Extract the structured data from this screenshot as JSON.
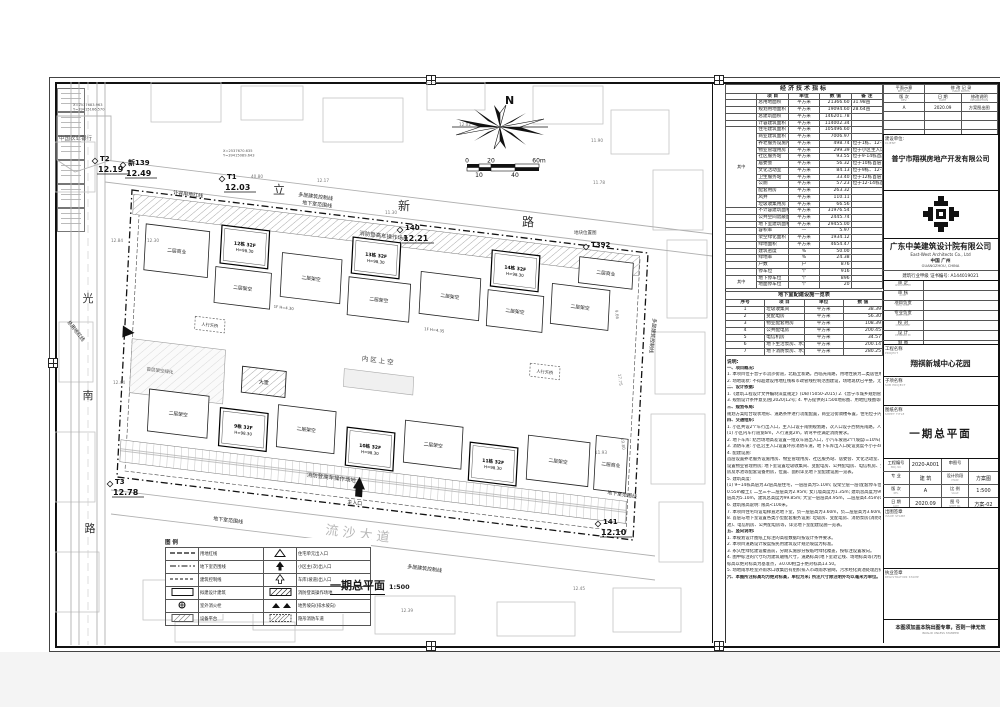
{
  "econ_table": {
    "title": "经济技术指标",
    "headers": [
      "项  目",
      "单位",
      "数  值",
      "备  注"
    ],
    "groups": [
      {
        "start": 4,
        "span": 12,
        "label": "其中"
      },
      {
        "start": 26,
        "span": 2,
        "label": "其中"
      }
    ],
    "rows": [
      [
        "总用地面积",
        "平方米",
        "21366.60",
        "31.98亩"
      ],
      [
        "规划用地面积",
        "平方米",
        "19094.60",
        "28.64亩"
      ],
      [
        "总建筑面积",
        "平方米",
        "146201.78",
        ""
      ],
      [
        "计容建筑面积",
        "平方米",
        "114002.34",
        ""
      ],
      [
        "住宅建筑面积",
        "平方米",
        "105496.60",
        ""
      ],
      [
        "商业建筑面积",
        "平方米",
        "7006.97",
        ""
      ],
      [
        "养老服务设施用房",
        "平方米",
        "498.74",
        "位于1栋、12-14栋首层"
      ],
      [
        "物业管理用房",
        "平方米",
        "299.39",
        "位于小区主入口首二层"
      ],
      [
        "社区服务站",
        "平方米",
        "93.55",
        "位于9-14栋首层"
      ],
      [
        "居委会",
        "平方米",
        "56.32",
        "位于10栋首层"
      ],
      [
        "文化活动室",
        "平方米",
        "84.13",
        "位于9栋、12-14栋首层"
      ],
      [
        "卫生服务站",
        "平方米",
        "33.40",
        "位于12栋首层"
      ],
      [
        "公厕",
        "平方米",
        "57.23",
        "位于12-14栋首层"
      ],
      [
        "配套用房",
        "平方米",
        "263.32",
        ""
      ],
      [
        "风井",
        "平方米",
        "110.11",
        ""
      ],
      [
        "垃圾收集用房",
        "平方米",
        "66.56",
        ""
      ],
      [
        "不计容建筑面积",
        "平方米",
        "31976.54",
        ""
      ],
      [
        "公共空间遮蔽面积",
        "平方米",
        "2445.74",
        ""
      ],
      [
        "地下室建筑面积",
        "平方米",
        "29455.00",
        ""
      ],
      [
        "容积率",
        "—",
        "5.97",
        ""
      ],
      [
        "架空绿化面积",
        "平方米",
        "1934.12",
        ""
      ],
      [
        "绿地面积",
        "平方米",
        "4654.47",
        ""
      ],
      [
        "建筑密度",
        "%",
        "50.00",
        ""
      ],
      [
        "绿地率",
        "%",
        "24.38",
        ""
      ],
      [
        "户数",
        "户",
        "876",
        ""
      ],
      [
        "停车位",
        "个",
        "916",
        ""
      ],
      [
        "地下停车位",
        "个",
        "896",
        ""
      ],
      [
        "地面停车位",
        "个",
        "20",
        ""
      ]
    ]
  },
  "facility_table": {
    "title": "地下室配建设施一览表",
    "headers": [
      "序号",
      "项  目",
      "单位",
      "数  值"
    ],
    "rows": [
      [
        "1",
        "垃圾收集间",
        "平方米",
        "38.39"
      ],
      [
        "2",
        "变配电房",
        "平方米",
        "56.30"
      ],
      [
        "3",
        "物业配套用房",
        "平方米",
        "108.39"
      ],
      [
        "4",
        "公共配电房",
        "平方米",
        "200.45"
      ],
      [
        "5",
        "电信机房",
        "平方米",
        "34.57"
      ],
      [
        "6",
        "地下生活泵房、水池",
        "平方米",
        "200.14"
      ],
      [
        "7",
        "地下消防泵房、水池",
        "平方米",
        "280.25"
      ]
    ]
  },
  "notes": {
    "title": "说明:",
    "lines": [
      "一、项目概况:",
      "1. 本项目位于普宁市流沙街道，北临立新路，西临光南路，用地性质为二类居住用地。",
      "2. 场地现状: 不得超建设用地红线和市政管线控制范围建设，场地现状已平整，无保留建筑物。",
      "二、设计依据:",
      "1.《建筑工程设计文件编制深度规定》(DB/T5050-2015)   2.《普宁市城乡规划管理技术规定》",
      "3. 规划设计条件意见函[2020]12号;  4. 甲方提供的1:500地形图、用地红线图等相关资料。",
      "三、规划布局:",
      "规划方案结合现状地形、道路条件进行功能配置，商业沿街骑楼布置，住宅位于内区，形成完整小区。",
      "四、交通组织:",
      "1. 小区共设2个车行出入口，主入口设于南侧规划路，次入口设于西侧光南路，人车分流。",
      "(1) 小区内车行道宽6m，人行道宽2m，转弯半径满足消防要求。",
      "2. 地下车库: 结合场地高差设置一组双车道出入口，小汽车坡道2个(坡度i=10%)，直通地下停车库。",
      "3. 消防车道: 小区沿主入口设置环形消防车道，地下车库出入口处设宽度不小于4m消防通道。",
      "4. 配建设施:",
      "首层设置养老服务设施用房、物业管理用房、社区服务站、居委会、文化活动室、卫生服务站等; 住宅二层",
      "设置物业管理用房; 地下室设置垃圾收集间、变配电房、公共配电房、电信机房、生活泵房及水池、消防泵",
      "房及水池等配套设备用房，位置、面积详见地下室配建设施一览表。",
      "5. 建筑高度:",
      "(1) 9~14栋高层为32层高层住宅，一层层高为5.10m; 设架空层一层(配套停车位)，层高为4.45m(3.9m+",
      "0.55m覆土); 二至三十二层层高为2.95m; 女儿墙高度为1.35m; 建筑总高度为99.85m; 14栋含一层为商业，",
      "层高为5.10m，建筑总高度为99.85m; 大堂一层层高4.95m，二层层高4.45m(0.4m覆土层)，总高度99.75m。",
      "6. 建筑限高说明: 限高<100米。",
      "7. 本项目住宅均设电梯直达地下室，负一层层高为3.60m，负二层层高为3.60m。",
      "8. 首层与地下室设置各类小型配套服务设施: 垃圾房、变配电房、消防泵房(消防水池)、生活泵房(生活水",
      "池)、电信机房、公共配电房等，详见地下室配建设施一览表。",
      "五、竖向说明:",
      "1. 本规划设计图纸上标注的高程数据均按设计条件要求。",
      "2. 本项目道路设计坡度按民用建筑设计规范坡度为标准。",
      "3. 永久性绿化建设覆盖前，分期实施部分按临时绿化覆盖，按标注设置坡向。",
      "4. 图中标注的尺寸均为建筑轴线尺寸，道路标高(地下室退让线、场地标高等)为控制点标高，建筑物设计",
      "标高以绝对标高为基准点，±0.00相当于绝对标高13.50。",
      "5. 场地雨水经室外雨水口收集后有组织排入市政雨水管网，污水经化粪池处理后排入市政污水管。",
      "六、本图所注标高均为绝对标高，单位为米; 所注尺寸除注明外均以毫米为单位。"
    ]
  },
  "revision": {
    "key_plan": "平面示意",
    "key_plan_en": "KEY PLAN",
    "title": "修 改 记 录",
    "title_en": "ISSUE NOTES",
    "headers": [
      {
        "cn": "版 次",
        "en": "REV."
      },
      {
        "cn": "日 期",
        "en": "DATE"
      },
      {
        "cn": "修改说明",
        "en": "DESCRIPTION"
      }
    ],
    "rows": [
      [
        "A",
        "2020.09",
        "方案图出图"
      ],
      [
        "",
        "",
        ""
      ],
      [
        "",
        "",
        ""
      ],
      [
        "",
        "",
        ""
      ]
    ]
  },
  "client": {
    "label": "建设单位:",
    "label_en": "CLIENT",
    "name": "普宁市翔祺房地产开发有限公司"
  },
  "firm": {
    "name": "广东中美建筑设计院有限公司",
    "name_en": "East-West Architects Co., Ltd",
    "city": "中国 广州",
    "city_en": "GUANGZHOU, CHINA",
    "cert": "建筑行业甲级  证书编号: A144019021"
  },
  "signatures": [
    {
      "cn": "审 定",
      "en": "APPROVED BY"
    },
    {
      "cn": "审 核",
      "en": "AUDIT"
    },
    {
      "cn": "项目负责",
      "en": "PROJ. CHIEF"
    },
    {
      "cn": "专业负责",
      "en": "PROF. CHIEF"
    },
    {
      "cn": "校 对",
      "en": "CHECKED BY"
    },
    {
      "cn": "设 计",
      "en": "DESIGNED BY"
    },
    {
      "cn": "制 图",
      "en": "DRAWN BY"
    }
  ],
  "project": {
    "label": "工程名称",
    "label_en": "PROJECT",
    "name": "翔祺新城中心花园"
  },
  "subproject": {
    "label": "子项名称",
    "label_en": "SUB PROJECT",
    "name": ""
  },
  "sheet_title": {
    "label": "图纸名称",
    "label_en": "SHEET TITLE",
    "name": "一期总平面"
  },
  "info_grid": [
    {
      "l1": "工程编号",
      "e1": "PROJ. NO.",
      "v1": "2020-A001",
      "l2": "审图号",
      "e2": "",
      "v2": ""
    },
    {
      "l1": "专 业",
      "e1": "",
      "v1": "建 筑",
      "l2": "设计阶段",
      "e2": "PHASE",
      "v2": "方案图"
    },
    {
      "l1": "版 次",
      "e1": "REV.",
      "v1": "A",
      "l2": "比 例",
      "e2": "SCALE",
      "v2": "1:500"
    },
    {
      "l1": "日 期",
      "e1": "DATE",
      "v1": "2020.09",
      "l2": "图 号",
      "e2": "SHEET NO.",
      "v2": "方案-02"
    }
  ],
  "stamps": {
    "issue_cn": "出图签章",
    "issue_en": "ISSUE STAMP",
    "reg_cn": "执业签章",
    "reg_en": "REGISTRATION STAMP",
    "notice": "本图须加盖本院出图专章，否则一律无效",
    "notice_en": "INVALID UNLESS STAMPED"
  },
  "plan": {
    "title": "一期总平面",
    "scale": "1:500",
    "north_label": "N",
    "scalebar_labels_top": [
      "0",
      "20",
      "60m"
    ],
    "scalebar_labels_bottom": [
      "10",
      "40"
    ],
    "bank_label": "中国农业银行",
    "road_labels": [
      {
        "t": "光",
        "x": 33,
        "y": 220,
        "s": 11
      },
      {
        "t": "南",
        "x": 33,
        "y": 317,
        "s": 11
      },
      {
        "t": "路",
        "x": 35,
        "y": 450,
        "s": 11
      },
      {
        "t": "立",
        "x": 224,
        "y": 112,
        "s": 12
      },
      {
        "t": "新",
        "x": 349,
        "y": 128,
        "s": 12
      },
      {
        "t": "路",
        "x": 473,
        "y": 144,
        "s": 12
      }
    ],
    "street_name": {
      "t": "流 沙 大 道",
      "x": 270,
      "y": 452,
      "r": 7
    },
    "benchmarks": [
      {
        "name": "T2",
        "elev": "12.19",
        "x": 40,
        "y": 78
      },
      {
        "name": "新139",
        "elev": "12.49",
        "x": 68,
        "y": 82
      },
      {
        "name": "T1",
        "elev": "12.03",
        "x": 167,
        "y": 96
      },
      {
        "name": "140",
        "elev": "12.21",
        "x": 345,
        "y": 147
      },
      {
        "name": "T392",
        "elev": "",
        "x": 531,
        "y": 164
      },
      {
        "name": "141",
        "elev": "12.10",
        "x": 543,
        "y": 441
      },
      {
        "name": "T3",
        "elev": "12.78",
        "x": 55,
        "y": 401
      }
    ],
    "map_ref": {
      "t": "地块位置图",
      "x": 519,
      "y": 152
    },
    "coords": [
      {
        "t1": "X=2537683.963",
        "t2": "Y=39415166.570",
        "x": 18,
        "y": 24
      },
      {
        "t1": "X=2537670.635",
        "t2": "Y=39415089.643",
        "x": 168,
        "y": 70
      }
    ],
    "line_labels": [
      {
        "t": "计容用地红线",
        "x": 118,
        "y": 112,
        "r": 7
      },
      {
        "t": "多层建筑控制线",
        "x": 243,
        "y": 114,
        "r": 7
      },
      {
        "t": "地下室范围线",
        "x": 247,
        "y": 122,
        "r": 7
      },
      {
        "t": "地下室范围线",
        "x": 158,
        "y": 438,
        "r": 7
      },
      {
        "t": "计容用地红线",
        "x": 120,
        "y": 464,
        "r": 7
      },
      {
        "t": "多层建筑控制线",
        "x": 352,
        "y": 486,
        "r": 7
      },
      {
        "t": "多层建筑控制线",
        "x": 598,
        "y": 236,
        "r": 96
      },
      {
        "t": "地下室范围线",
        "x": 552,
        "y": 412,
        "r": 8
      },
      {
        "t": "总用地红线",
        "x": 12,
        "y": 240,
        "r": 52
      }
    ],
    "spot_elevations": [
      {
        "v": "12.02",
        "x": 404,
        "y": 44
      },
      {
        "v": "11.90",
        "x": 536,
        "y": 60
      },
      {
        "v": "11.78",
        "x": 538,
        "y": 102
      },
      {
        "v": "11.93",
        "x": 540,
        "y": 372
      },
      {
        "v": "12.45",
        "x": 518,
        "y": 508
      },
      {
        "v": "12.84",
        "x": 56,
        "y": 160
      },
      {
        "v": "12.30",
        "x": 92,
        "y": 160
      },
      {
        "v": "12.83",
        "x": 118,
        "y": 480
      },
      {
        "v": "12.72",
        "x": 232,
        "y": 494
      },
      {
        "v": "12.73",
        "x": 112,
        "y": 524
      },
      {
        "v": "12.39",
        "x": 346,
        "y": 530
      },
      {
        "v": "12.44",
        "x": 58,
        "y": 302
      },
      {
        "v": "12.17",
        "x": 262,
        "y": 100
      },
      {
        "v": "40.80",
        "x": 196,
        "y": 96
      },
      {
        "v": "11.30",
        "x": 330,
        "y": 132
      },
      {
        "v": "9.66",
        "x": 560,
        "y": 228,
        "r": 83
      },
      {
        "v": "17.75",
        "x": 563,
        "y": 292,
        "r": 83
      },
      {
        "v": "19.80",
        "x": 566,
        "y": 356,
        "r": 83
      }
    ],
    "site": {
      "boundary": [
        [
          77,
          108
        ],
        [
          593,
          171
        ],
        [
          578,
          458
        ],
        [
          62,
          395
        ]
      ],
      "fire_lane_label": "消防登高车操作场地",
      "courtyard_label": "内区上空",
      "bridge_label": "人行天桥",
      "lobby_label": "大堂",
      "green_label": "首层架空绿化",
      "main_entrance_label": "主入口",
      "small_texts": [
        {
          "t": "1F H=4.30",
          "x": 148,
          "y": 100
        },
        {
          "t": "1F H=4.35",
          "x": 300,
          "y": 104
        }
      ],
      "buildings": [
        {
          "x": 16,
          "y": 32,
          "w": 64,
          "h": 46,
          "t": "p",
          "label": "二层商业"
        },
        {
          "x": 92,
          "y": 24,
          "w": 48,
          "h": 38,
          "t": "tw",
          "label": "12栋 32F",
          "sub": "H=98.30"
        },
        {
          "x": 88,
          "y": 66,
          "w": 56,
          "h": 36,
          "t": "p",
          "label": "二层架空"
        },
        {
          "x": 154,
          "y": 44,
          "w": 60,
          "h": 44,
          "t": "p",
          "label": "二层架空"
        },
        {
          "x": 224,
          "y": 20,
          "w": 48,
          "h": 36,
          "t": "tw",
          "label": "13栋 32F",
          "sub": "H=98.30"
        },
        {
          "x": 222,
          "y": 60,
          "w": 62,
          "h": 38,
          "t": "p",
          "label": "二层架空"
        },
        {
          "x": 294,
          "y": 46,
          "w": 60,
          "h": 42,
          "t": "p",
          "label": "二层架空"
        },
        {
          "x": 364,
          "y": 16,
          "w": 48,
          "h": 36,
          "t": "tw",
          "label": "14栋 32F",
          "sub": "H=98.30"
        },
        {
          "x": 362,
          "y": 56,
          "w": 56,
          "h": 36,
          "t": "p",
          "label": "二层架空"
        },
        {
          "x": 426,
          "y": 42,
          "w": 58,
          "h": 40,
          "t": "p",
          "label": "二层架空"
        },
        {
          "x": 452,
          "y": 12,
          "w": 54,
          "h": 26,
          "t": "p",
          "label": "二层商业"
        },
        {
          "x": 28,
          "y": 196,
          "w": 60,
          "h": 42,
          "t": "p",
          "label": "二层架空"
        },
        {
          "x": 100,
          "y": 206,
          "w": 48,
          "h": 38,
          "t": "tw",
          "label": "9栋 32F",
          "sub": "H=98.30"
        },
        {
          "x": 158,
          "y": 196,
          "w": 58,
          "h": 42,
          "t": "p",
          "label": "二层架空"
        },
        {
          "x": 228,
          "y": 210,
          "w": 48,
          "h": 38,
          "t": "tw",
          "label": "10栋 32F",
          "sub": "H=98.30"
        },
        {
          "x": 286,
          "y": 196,
          "w": 58,
          "h": 42,
          "t": "p",
          "label": "二层架空"
        },
        {
          "x": 352,
          "y": 210,
          "w": 48,
          "h": 38,
          "t": "tw",
          "label": "11栋 32F",
          "sub": "H=98.30"
        },
        {
          "x": 410,
          "y": 196,
          "w": 62,
          "h": 44,
          "t": "p",
          "label": "二层架空"
        },
        {
          "x": 478,
          "y": 188,
          "w": 32,
          "h": 54,
          "t": "p",
          "label": "二层商业"
        }
      ]
    },
    "legend": {
      "title": "图 例",
      "left": [
        {
          "sym": "dash",
          "label": "用地红线"
        },
        {
          "sym": "dashdot",
          "label": "地下室范围线"
        },
        {
          "sym": "dash2",
          "label": "建筑控制线"
        },
        {
          "sym": "rect",
          "label": "拟建设计建筑"
        },
        {
          "sym": "hydrant",
          "label": "室外消火栓"
        },
        {
          "sym": "hatch",
          "label": "设备平台"
        }
      ],
      "right": [
        {
          "sym": "tri",
          "label": "住宅单元出入口"
        },
        {
          "sym": "arrow",
          "label": "小区主(次)出入口"
        },
        {
          "sym": "oarrow",
          "label": "车库(坡道)出入口"
        },
        {
          "sym": "hatch2",
          "label": "消防登高操作场地"
        },
        {
          "sym": "slope",
          "label": "地势坡向(排水坡向)"
        },
        {
          "sym": "hatch3",
          "label": "隐形消防车道"
        }
      ]
    }
  }
}
